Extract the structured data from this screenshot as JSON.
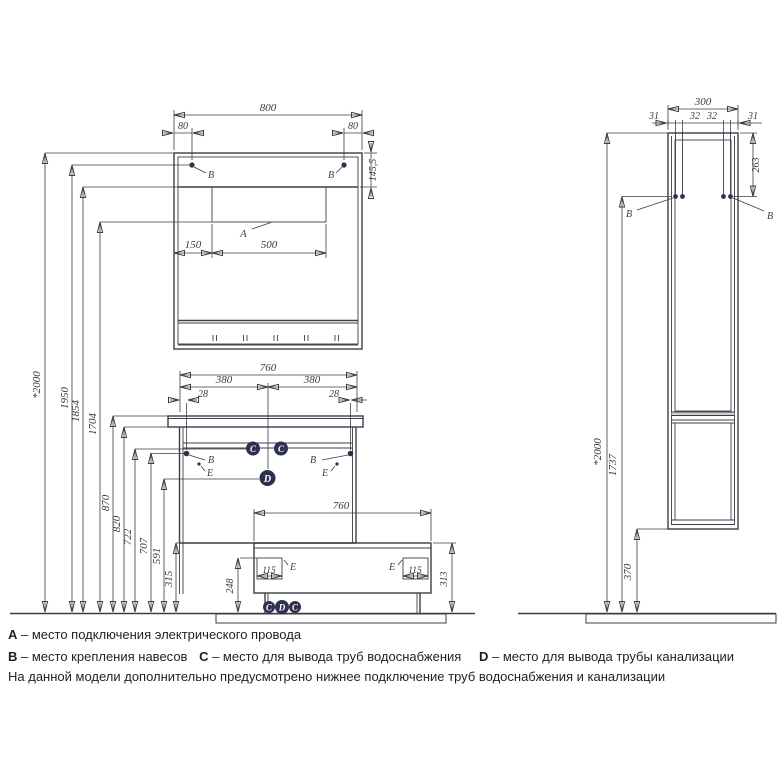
{
  "drawing_title": "furniture installation dimensions",
  "labels": {
    "a": "A",
    "b": "B",
    "c": "C",
    "d": "D",
    "e": "E"
  },
  "dims": {
    "mirror": {
      "w": "800",
      "l80": "80",
      "r80": "80",
      "strip_h": "145,5",
      "off": "150",
      "hatch_w": "500"
    },
    "left": [
      "*2000",
      "1950",
      "1854",
      "1704",
      "870",
      "820",
      "722",
      "707",
      "591",
      "315"
    ],
    "vanity": {
      "w": "760",
      "half_l": "380",
      "half_r": "380",
      "edge_l": "28",
      "edge_r": "28"
    },
    "base": {
      "w": "760",
      "notch_l": "115",
      "notch_r": "115",
      "h_inner": "248",
      "h_outer": "313"
    },
    "column": {
      "w": "300",
      "p1": "31",
      "p2": "32",
      "p3": "32",
      "p4": "31",
      "pin_depth": "263",
      "height": "*2000",
      "hang": "1737",
      "bottom": "370"
    }
  },
  "legend": {
    "items": [
      {
        "key": "А",
        "text": "– место подключения электрического провода"
      },
      {
        "key": "В",
        "text": "– место крепления навесов"
      },
      {
        "key": "С",
        "text": "– место для вывода труб водоснабжения"
      },
      {
        "key": "D",
        "text": "– место для вывода трубы канализации"
      }
    ],
    "note": "На данной модели дополнительно предусмотрено нижнее подключение труб водоснабжения и канализации"
  },
  "colors": {
    "line": "#3d3d47",
    "marker_fill": "#2e3050",
    "divider_band": "#cdcdd3"
  }
}
